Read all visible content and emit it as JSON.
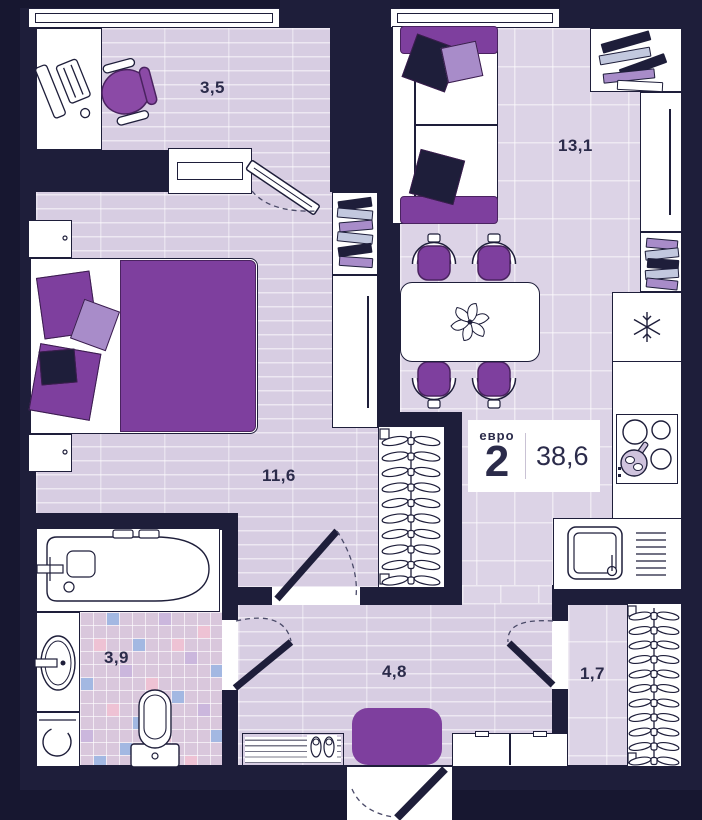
{
  "badge": {
    "type_label": "евро",
    "rooms_number": "2",
    "area_value": "38,6"
  },
  "room_labels": {
    "balcony": "3,5",
    "living_kitchen": "13,1",
    "bedroom": "11,6",
    "bathroom": "3,9",
    "hallway": "4,8",
    "wardrobe": "1,7"
  },
  "icons": {
    "fridge": "snowflake-icon",
    "dining_centerpiece": "flower-icon"
  },
  "colors": {
    "bg": "#171730",
    "wall": "#1e1e3a",
    "floor": "#d7cde2",
    "tile": "#dcd3e6",
    "accent": "#7e3f9e",
    "accentlight": "#a88cc9",
    "steel": "#c2c8de",
    "label": "#2b2b4a",
    "mosaic": "#d9c7dc",
    "pink": "#eec2d4",
    "blue": "#a3b8e2",
    "violet": "#cbb7dd"
  }
}
